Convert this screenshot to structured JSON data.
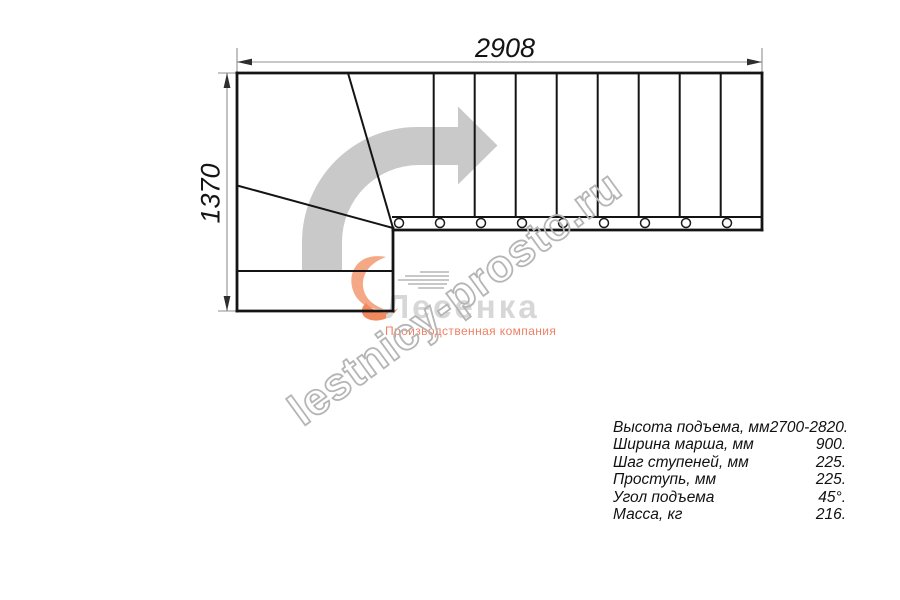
{
  "drawing": {
    "top_dimension": "2908",
    "left_dimension": "1370"
  },
  "watermark": {
    "text": "lestnicy-prosto.ru",
    "color": "#b5b5b5"
  },
  "logo": {
    "name": "Лесенка",
    "subtitle": "Производственная компания",
    "name_color": "#d7d7d7",
    "subtitle_color": "#ee8164",
    "flame_color": "#f5a886",
    "flame_tail_color": "#ef8a5f"
  },
  "specs": {
    "rows": [
      {
        "label": "Высота подъема, мм",
        "value": "2700-2820."
      },
      {
        "label": "Ширина марша, мм",
        "value": "900."
      },
      {
        "label": "Шаг ступеней, мм",
        "value": "225."
      },
      {
        "label": "Проступь, мм",
        "value": "225."
      },
      {
        "label": "Угол подъема",
        "value": "45°."
      },
      {
        "label": "Масса, кг",
        "value": "216."
      }
    ]
  },
  "colors": {
    "line": "#141414",
    "dimension_line": "#8f8f8f",
    "direction_arrow": "#c9c9c9",
    "background": "#ffffff"
  }
}
